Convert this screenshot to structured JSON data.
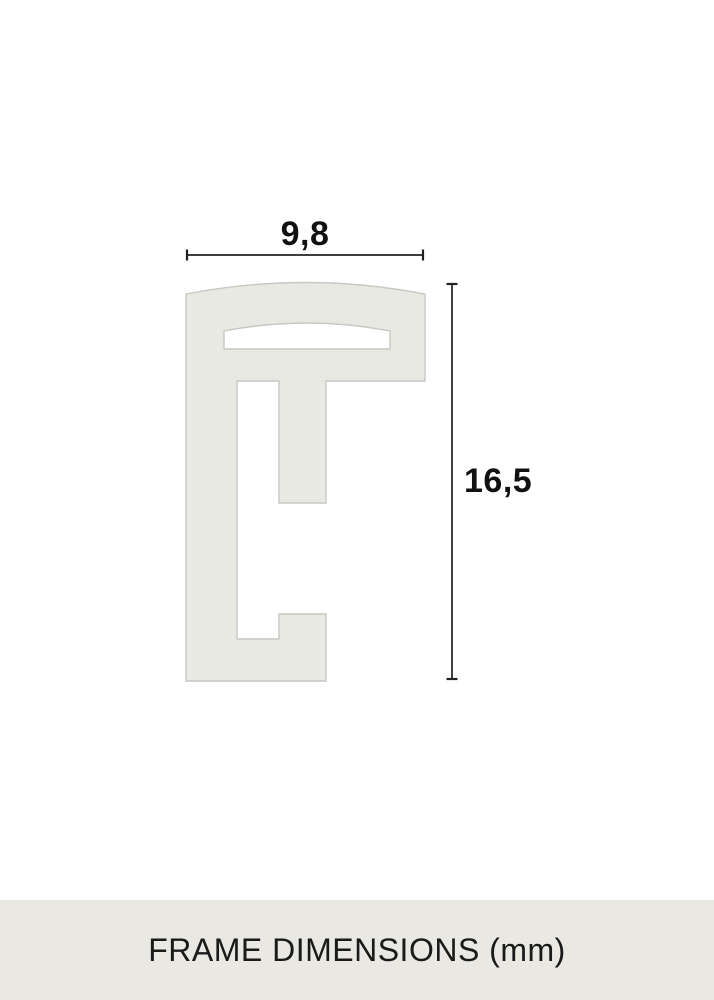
{
  "page": {
    "background": "#ffffff"
  },
  "diagram": {
    "width_value": "9,8",
    "height_value": "16,5",
    "profile_fill": "#e9e9e4",
    "profile_stroke": "#c8c7c1",
    "dimension_color": "#222222",
    "label_color": "#111111"
  },
  "footer": {
    "caption": "FRAME DIMENSIONS (mm)",
    "background": "#e9e8e3",
    "text_color": "#1a1a1a"
  }
}
